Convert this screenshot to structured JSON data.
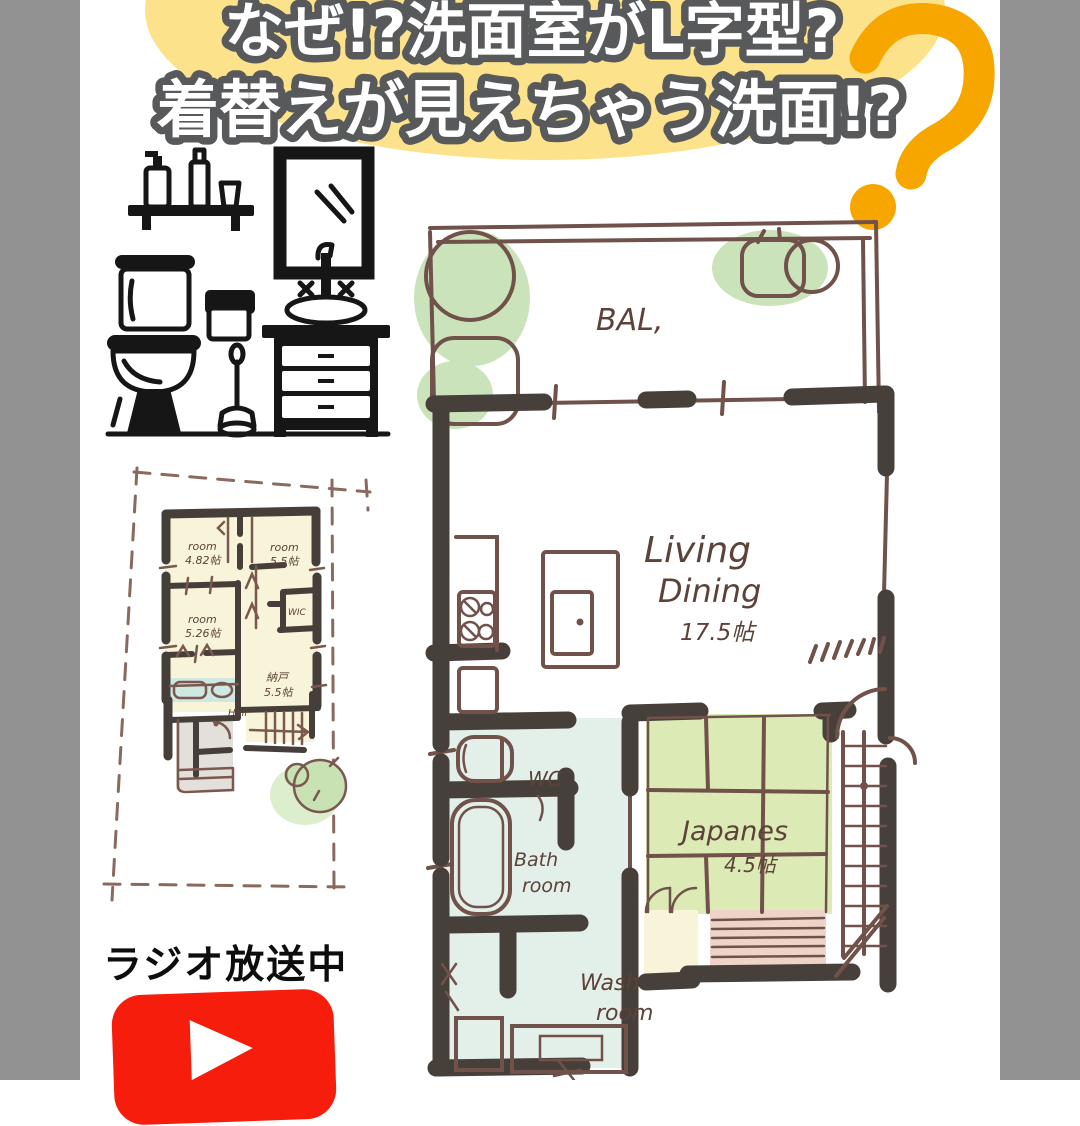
{
  "colors": {
    "side_border_gray": "#929292",
    "blob_yellow": "#FBE28B",
    "accent_orange": "#F7A600",
    "title_fill": "#FFFFFF",
    "title_outline": "#58595B",
    "wall_dark": "#47403A",
    "sketch_brown": "#70524A",
    "room_pale_yellow": "#F8F4D9",
    "tatami_green": "#DCEAB6",
    "plant_green": "#CBE3BA",
    "wet_area_blue": "#E3EFE9",
    "closet_pink": "#EDD3C8",
    "entrance_gray": "#E3DFDB",
    "youtube_red": "#F61D0D",
    "ink_black": "#161616"
  },
  "header": {
    "line1": "なぜ!?洗面室がL字型?",
    "line2": "着替えが見えちゃう洗面!?",
    "question_mark": "?"
  },
  "clipart": {
    "icons": [
      "shelf-icon",
      "pump-bottle-icon",
      "bottle-icon",
      "cup-icon",
      "mirror-icon",
      "faucet-icon",
      "basin-icon",
      "vanity-icon",
      "toilet-icon",
      "toilet-paper-box-icon",
      "plunger-icon"
    ]
  },
  "small_plan": {
    "rooms": [
      {
        "name": "room",
        "size": "4.82帖"
      },
      {
        "name": "room",
        "size": "5.5帖"
      },
      {
        "name": "room",
        "size": "5.26帖"
      },
      {
        "name": "WIC",
        "size": ""
      },
      {
        "name": "納戸",
        "size": "5.5帖"
      },
      {
        "name": "Hall",
        "size": ""
      }
    ]
  },
  "main_plan": {
    "balcony_label": "BAL,",
    "living": {
      "line1": "Living",
      "line2": "Dining",
      "size": "17.5帖"
    },
    "japanese": {
      "name": "Japanes",
      "size": "4.5帖"
    },
    "wc_label": "WC",
    "bath": {
      "line1": "Bath",
      "line2": "room"
    },
    "wash": {
      "line1": "Wash",
      "line2": "room"
    }
  },
  "footer": {
    "radio_label": "ラジオ放送中",
    "youtube_icon": "youtube-play-icon"
  }
}
